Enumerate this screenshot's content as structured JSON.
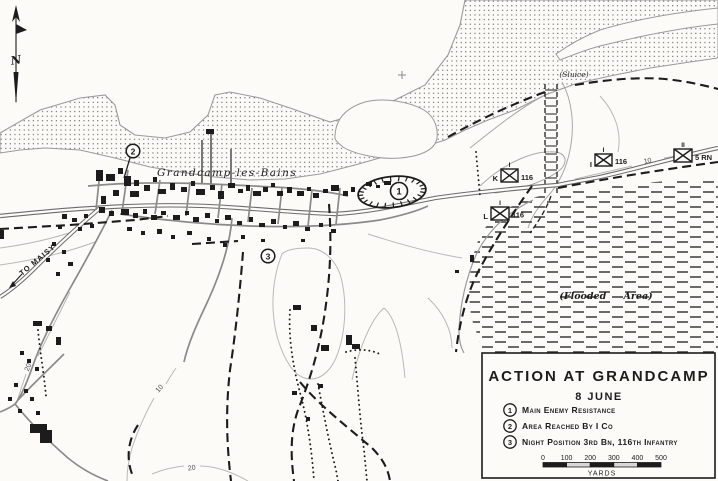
{
  "map": {
    "north_letter": "N",
    "labels": {
      "town": "Grandcamp-les-Bains",
      "sluice": "(Sluice)",
      "flooded": "(Flooded Area)",
      "to_maisy": "TO MAISY"
    },
    "contour_labels": [
      "20",
      "10",
      "20",
      "10"
    ],
    "markers": [
      "1",
      "2",
      "3"
    ],
    "units": [
      {
        "left": "K",
        "right": "116",
        "echelon": "I"
      },
      {
        "left": "L",
        "right": "116",
        "echelon": "I"
      },
      {
        "left": "I",
        "right": "116",
        "echelon": "I"
      },
      {
        "left": "",
        "right": "5 RN",
        "echelon": "II"
      }
    ]
  },
  "legend": {
    "title": "ACTION AT GRANDCAMP",
    "date": "8 JUNE",
    "items": [
      {
        "num": "1",
        "text": "Main Enemy Resistance"
      },
      {
        "num": "2",
        "text": "Area Reached By I Co"
      },
      {
        "num": "3",
        "text": "Night Position 3rd Bn, 116th Infantry"
      }
    ],
    "scale": {
      "ticks": [
        "0",
        "100",
        "200",
        "300",
        "400",
        "500"
      ],
      "unit": "YARDS"
    }
  },
  "colors": {
    "ink": "#1c1c1c",
    "paper": "#fcfbf7",
    "road": "#6b6b6b",
    "contour": "#b8b8b8"
  }
}
